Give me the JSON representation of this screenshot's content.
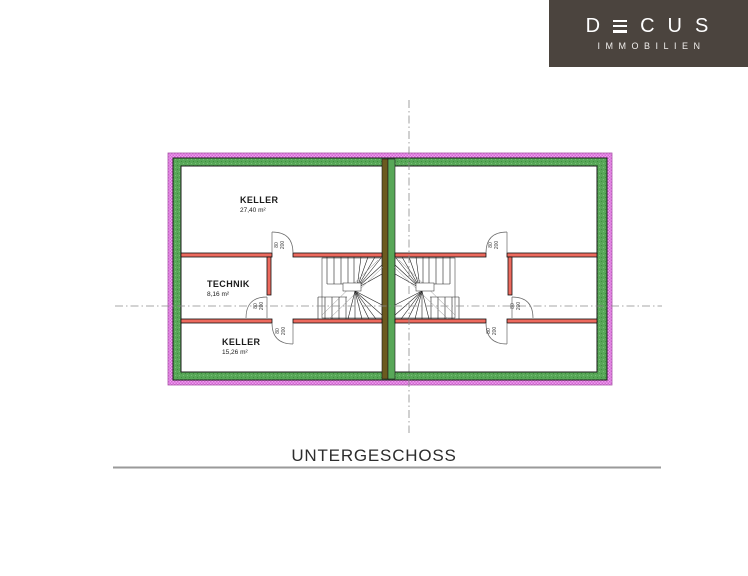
{
  "logo": {
    "brand_prefix": "D",
    "brand_suffix": "CUS",
    "brand_full": "DECUS",
    "subtitle": "IMMOBILIEN",
    "colors": {
      "background": "#4b443e",
      "text": "#ffffff"
    }
  },
  "floor_plan": {
    "rooms": [
      {
        "name": "KELLER",
        "area": "27,40 m²",
        "unit": "left",
        "position": "top"
      },
      {
        "name": "TECHNIK",
        "area": "8,16 m²",
        "unit": "left",
        "position": "middle"
      },
      {
        "name": "KELLER",
        "area": "15,26 m²",
        "unit": "left",
        "position": "bottom"
      }
    ],
    "door_label": {
      "width": "80",
      "height": "200"
    },
    "colors": {
      "exterior_band_pink": "#ef9fef",
      "exterior_band_pink_dot": "#d266d2",
      "exterior_wall_green": "#58a758",
      "party_wall_brown": "#6b5a1f",
      "party_wall_green": "#58a758",
      "interior_wall_red": "#ed6a5e",
      "outline": "#1c1c1c",
      "centerline": "#8a8a8a"
    }
  },
  "title": {
    "text": "UNTERGESCHOSS"
  }
}
